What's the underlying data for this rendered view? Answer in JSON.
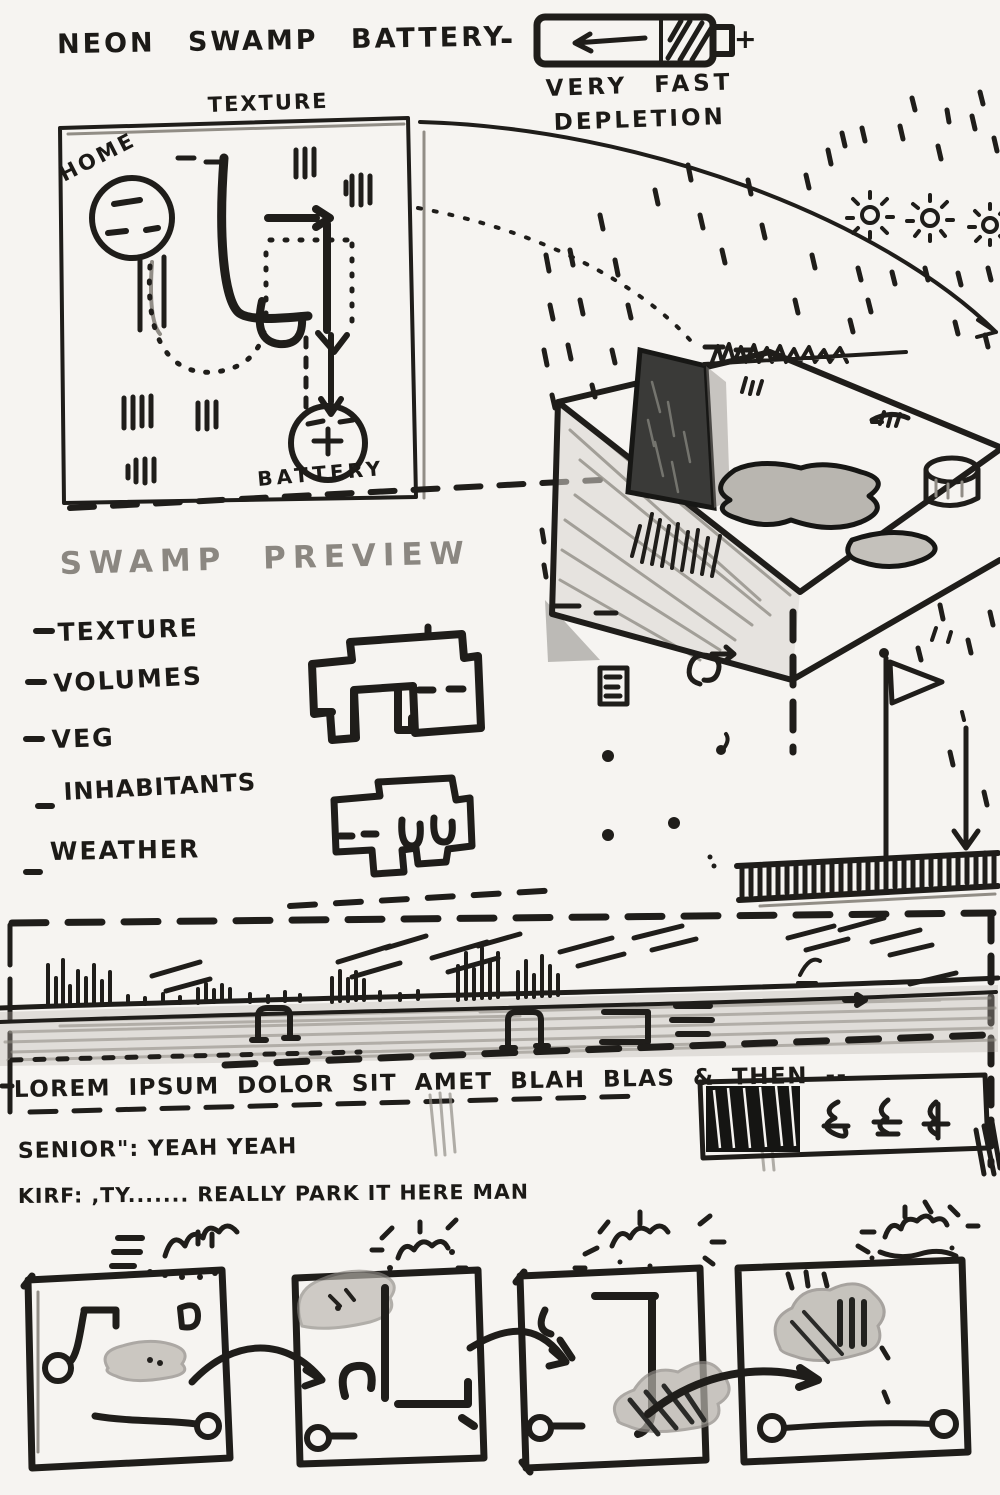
{
  "title": "NEON SWAMP BATTERY",
  "colors": {
    "ink": "#1f1d1a",
    "pencil": "#918d86",
    "paper": "#f6f4f1",
    "monolith": "#3a3a38",
    "puddle": "#b9b6b0"
  },
  "battery": {
    "minus_label": "-",
    "plus_label": "+",
    "caption_line1": "VERY FAST",
    "caption_line2": "DEPLETION"
  },
  "texture_map": {
    "label": "TEXTURE",
    "start_label": "HOME",
    "end_label": "BATTERY"
  },
  "preview": {
    "heading": "SWAMP PREVIEW",
    "checklist": [
      "TEXTURE",
      "VOLUMES",
      "VEG",
      "INHABITANTS",
      "WEATHER"
    ]
  },
  "strip": {
    "caption": "LOREM IPSUM DOLOR SIT AMET BLAH BLAS & THEN --"
  },
  "dialogue": {
    "line1": "SENIOR\": YEAH YEAH",
    "line2": "KIRF: ,TY....... REALLY PARK IT HERE MAN"
  }
}
